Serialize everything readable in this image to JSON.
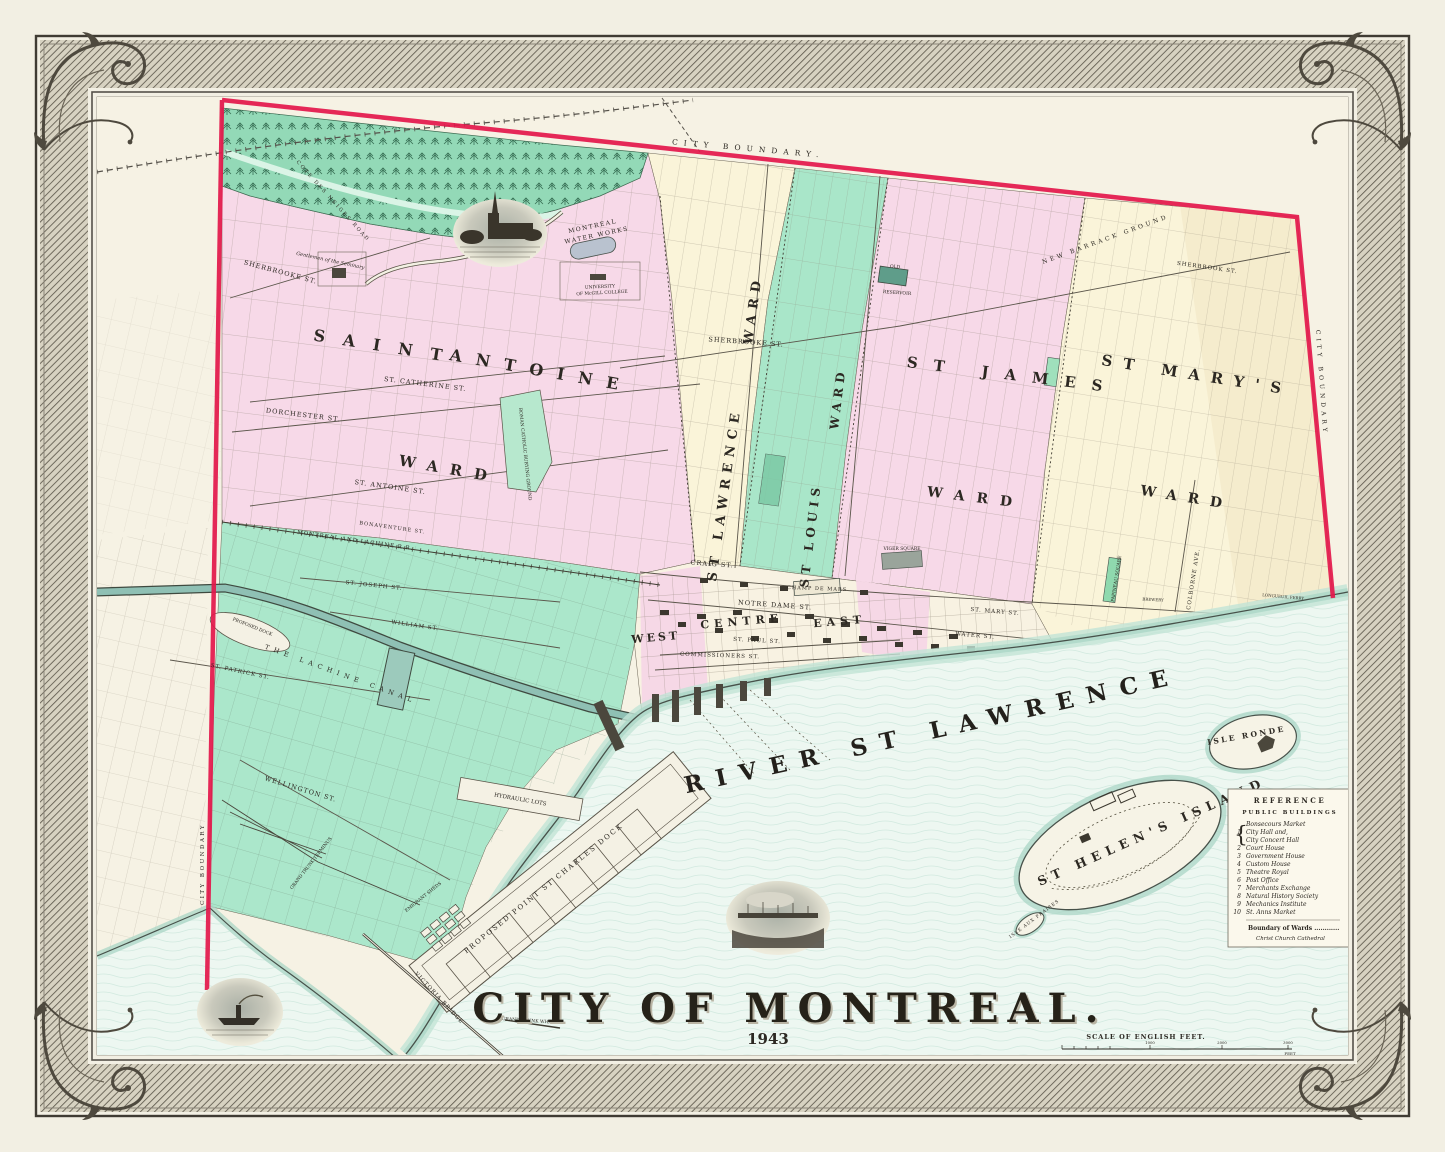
{
  "palette": {
    "paper": "#f2efe3",
    "map_paper": "#f6f2e4",
    "ink": "#2c2822",
    "boundary_red": "#e3174b",
    "ward_pink": "#f7d9e8",
    "ward_cream": "#faf4d9",
    "ward_green": "#a9e6c9",
    "forest_green": "#93d9b7",
    "water": "#edf7f1",
    "shore": "#a9d6c5",
    "frame_ink": "#55504400"
  },
  "title": {
    "text": "CITY OF MONTREAL.",
    "year": "1943"
  },
  "boundary": {
    "top": "CITY BOUNDARY.",
    "left": "CITY BOUNDARY",
    "right": "CITY BOUNDARY"
  },
  "wards": {
    "saint_antoine": {
      "l1": "SAINT",
      "l2": "ANTOINE",
      "l3": "WARD"
    },
    "st_lawrence": {
      "l1": "ST LAWRENCE",
      "l2": "WARD"
    },
    "st_louis": {
      "l1": "ST LOUIS",
      "l2": "WARD"
    },
    "st_james": {
      "l1": "ST JAMES",
      "l2": "WARD"
    },
    "st_marys": {
      "l1": "ST MARY'S",
      "l2": "WARD"
    },
    "west": "WEST",
    "centre": "CENTRE",
    "east": "EAST"
  },
  "water": {
    "river": "RIVER ST LAWRENCE",
    "helens": "ST HELEN'S ISLAND",
    "ronde": "ISLE RONDE",
    "fraises": "ISLE AUX FRAISES"
  },
  "streets": [
    "ST. CATHERINE ST.",
    "DORCHESTER ST.",
    "ST. ANTOINE ST.",
    "SHERBROOKE ST.",
    "SHERBROOKE ST.",
    "COTE DES NEIGES ROAD",
    "CRAIG ST.",
    "NOTRE DAME ST.",
    "ST. PAUL ST.",
    "COMMISSIONERS ST.",
    "ST. MARY ST.",
    "WATER ST.",
    "COLBORNE AVE.",
    "WELLINGTON ST.",
    "WILLIAM ST.",
    "ST. JOSEPH ST.",
    "ST. PATRICK ST.",
    "SHERBROOK ST.",
    "BONAVENTURE ST."
  ],
  "features": {
    "waterworks1": "MONTREAL",
    "waterworks2": "WATER WORKS",
    "mcgill1": "UNIVERSITY",
    "mcgill2": "OF McGILL COLLEGE",
    "barrack": "NEW BARRACK GROUND",
    "reservoir1": "OLD",
    "reservoir2": "RESERVOIR",
    "burying": "ROMAN CATHOLIC BURYING GROUND",
    "champ": "CHAMP DE MARS",
    "viger": "VIGER SQUARE",
    "seminary": "Gentlemen of the Seminary",
    "canal": "THE LACHINE CANAL",
    "railroad": "MONTREAL AND LACHINE R.R.",
    "proposed_dock": "PROPOSED DOCK",
    "hydraulic": "HYDRAULIC LOTS",
    "emigrant": "EMIGRANT SHEDS",
    "victoria": "VICTORIA BRIDGE",
    "gt_wharf": "GRAND TRUNK WHARF",
    "gt_terminus": "GRAND TRUNK TERMINUS",
    "psc_dock": "PROPOSED POINT ST CHARLES DOCK",
    "longueuil": "LONGUEUIL FERRY",
    "brewery": "BREWERY",
    "papineau": "PAPINEAU SQUARE"
  },
  "legend": {
    "title": "REFERENCE",
    "subtitle": "PUBLIC BUILDINGS",
    "brace": "{",
    "rows": [
      {
        "n": "",
        "name": "Bonsecours Market"
      },
      {
        "n": "1",
        "name": "City Hall and,"
      },
      {
        "n": "",
        "name": "City Concert Hall"
      },
      {
        "n": "2",
        "name": "Court House"
      },
      {
        "n": "3",
        "name": "Government House"
      },
      {
        "n": "4",
        "name": "Custom House"
      },
      {
        "n": "5",
        "name": "Theatre Royal"
      },
      {
        "n": "6",
        "name": "Post Office"
      },
      {
        "n": "7",
        "name": "Merchants Exchange"
      },
      {
        "n": "8",
        "name": "Natural History Society"
      },
      {
        "n": "9",
        "name": "Mechanics Institute"
      },
      {
        "n": "10",
        "name": "St. Anns Market"
      }
    ],
    "footer1": "Boundary of Wards ............",
    "footer2": "Christ Church Cathedral"
  },
  "scale": {
    "label": "SCALE OF ENGLISH FEET.",
    "t1": "1000",
    "t2": "2000",
    "t3": "3000",
    "unit": "FEET"
  }
}
